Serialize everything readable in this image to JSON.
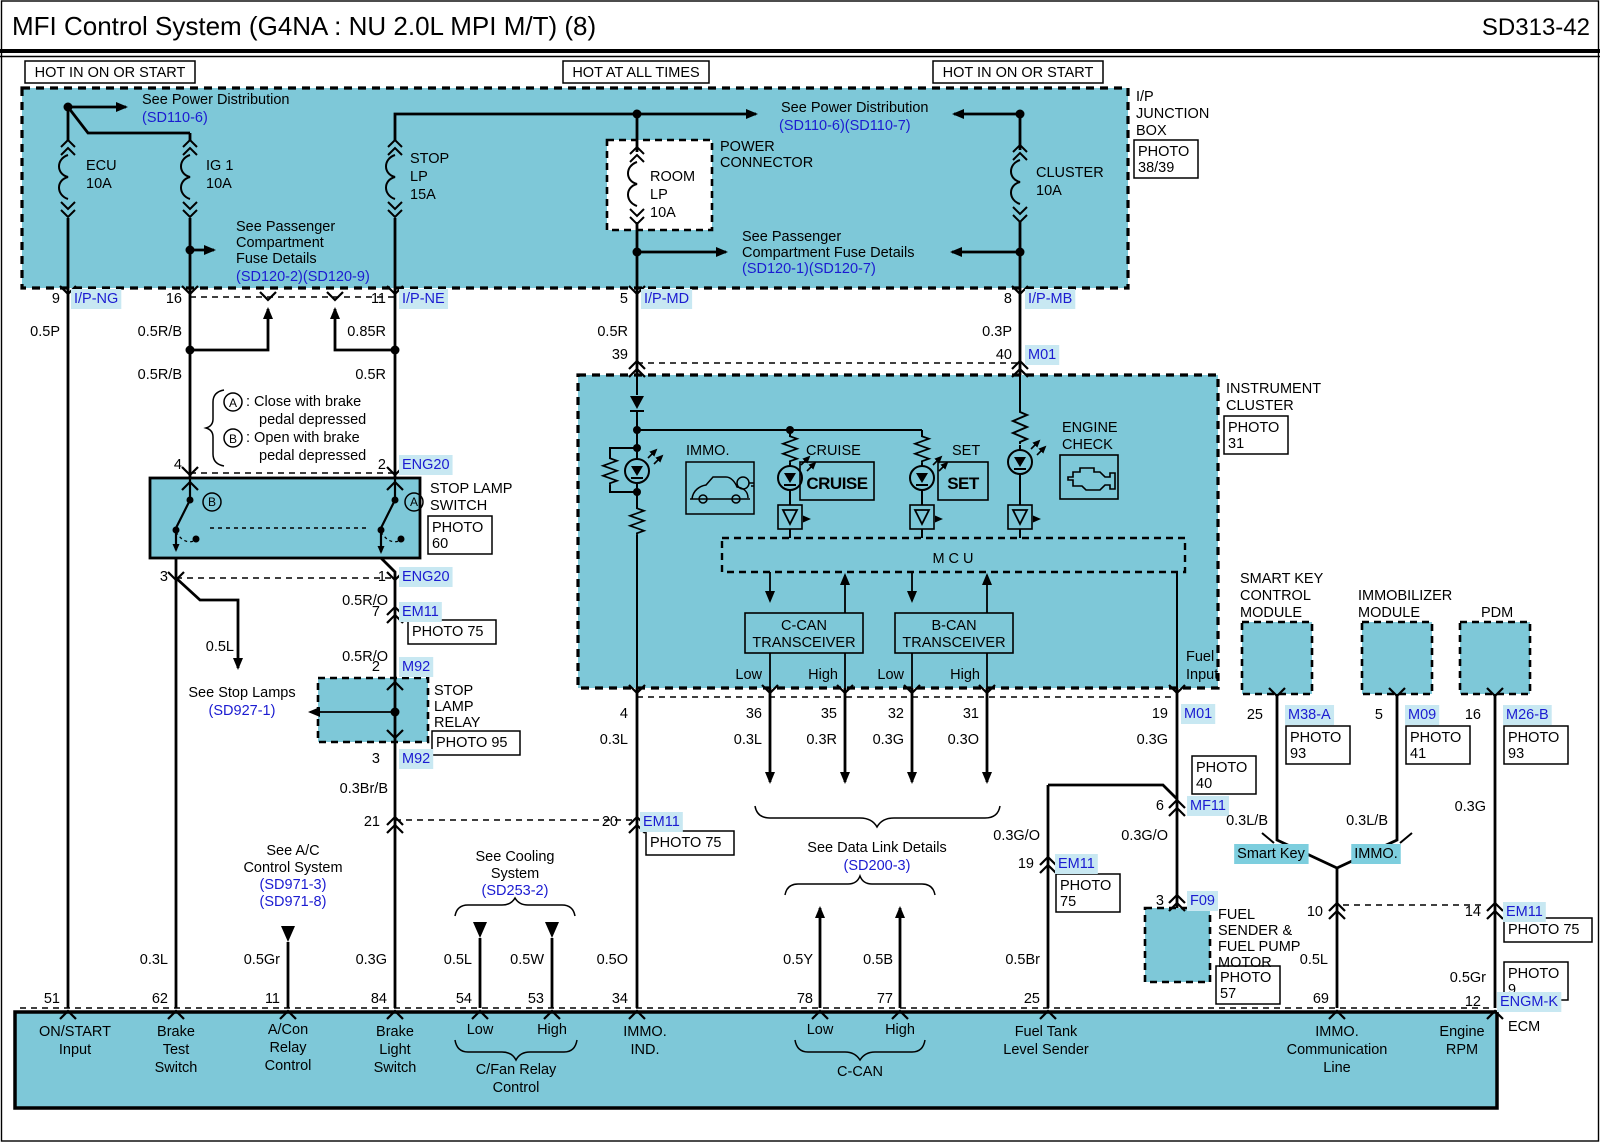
{
  "title": "MFI Control System (G4NA : NU 2.0L MPI M/T) (8)",
  "code": "SD313-42",
  "colors": {
    "fill": "#7ec8d8",
    "blue": "#1b1bd1",
    "hl": "#c8e8f2",
    "tag": "#7dcede",
    "line": "#000000"
  },
  "headers": [
    {
      "t": "HOT IN ON OR START",
      "x": 25,
      "y": 61,
      "w": 170,
      "h": 22
    },
    {
      "t": "HOT AT ALL TIMES",
      "x": 563,
      "y": 61,
      "w": 146,
      "h": 22
    },
    {
      "t": "HOT IN ON OR START",
      "x": 933,
      "y": 61,
      "w": 170,
      "h": 22
    }
  ],
  "photo_boxes": [
    {
      "lines": [
        "PHOTO",
        "38/39"
      ],
      "x": 1134,
      "y": 140,
      "w": 64,
      "h": 38
    },
    {
      "lines": [
        "PHOTO",
        "31"
      ],
      "x": 1224,
      "y": 416,
      "w": 64,
      "h": 38
    },
    {
      "lines": [
        "PHOTO",
        "60"
      ],
      "x": 428,
      "y": 516,
      "w": 64,
      "h": 38
    },
    {
      "lines": [
        "PHOTO 75"
      ],
      "x": 408,
      "y": 620,
      "w": 88,
      "h": 24
    },
    {
      "lines": [
        "PHOTO 95"
      ],
      "x": 432,
      "y": 731,
      "w": 88,
      "h": 24
    },
    {
      "lines": [
        "PHOTO 75"
      ],
      "x": 646,
      "y": 831,
      "w": 88,
      "h": 24
    },
    {
      "lines": [
        "PHOTO",
        "40"
      ],
      "x": 1192,
      "y": 756,
      "w": 64,
      "h": 38
    },
    {
      "lines": [
        "PHOTO",
        "75"
      ],
      "x": 1056,
      "y": 874,
      "w": 64,
      "h": 38
    },
    {
      "lines": [
        "PHOTO",
        "57"
      ],
      "x": 1216,
      "y": 966,
      "w": 64,
      "h": 38
    },
    {
      "lines": [
        "PHOTO",
        "93"
      ],
      "x": 1286,
      "y": 726,
      "w": 64,
      "h": 38
    },
    {
      "lines": [
        "PHOTO",
        "41"
      ],
      "x": 1406,
      "y": 726,
      "w": 64,
      "h": 38
    },
    {
      "lines": [
        "PHOTO",
        "93"
      ],
      "x": 1504,
      "y": 726,
      "w": 64,
      "h": 38
    },
    {
      "lines": [
        "PHOTO 75"
      ],
      "x": 1504,
      "y": 918,
      "w": 88,
      "h": 24
    },
    {
      "lines": [
        "PHOTO",
        "9"
      ],
      "x": 1504,
      "y": 962,
      "w": 64,
      "h": 38
    }
  ],
  "labels": [
    {
      "t": "See Power Distribution",
      "x": 142,
      "y": 104
    },
    {
      "t": "(SD110-6)",
      "x": 142,
      "y": 122,
      "c": "b"
    },
    {
      "t": "ECU",
      "x": 86,
      "y": 170
    },
    {
      "t": "10A",
      "x": 86,
      "y": 188
    },
    {
      "t": "IG 1",
      "x": 206,
      "y": 170
    },
    {
      "t": "10A",
      "x": 206,
      "y": 188
    },
    {
      "t": "See Passenger",
      "x": 236,
      "y": 231
    },
    {
      "t": "Compartment",
      "x": 236,
      "y": 247
    },
    {
      "t": "Fuse Details",
      "x": 236,
      "y": 263
    },
    {
      "t": "(SD120-2)(SD120-9)",
      "x": 236,
      "y": 281,
      "c": "b"
    },
    {
      "t": "STOP",
      "x": 410,
      "y": 163
    },
    {
      "t": "LP",
      "x": 410,
      "y": 181
    },
    {
      "t": "15A",
      "x": 410,
      "y": 199
    },
    {
      "t": "ROOM",
      "x": 650,
      "y": 181
    },
    {
      "t": "LP",
      "x": 650,
      "y": 199
    },
    {
      "t": "10A",
      "x": 650,
      "y": 217
    },
    {
      "t": "POWER",
      "x": 720,
      "y": 151
    },
    {
      "t": "CONNECTOR",
      "x": 720,
      "y": 167
    },
    {
      "t": "See Power Distribution",
      "x": 781,
      "y": 112
    },
    {
      "t": "(SD110-6)(SD110-7)",
      "x": 779,
      "y": 130,
      "c": "b"
    },
    {
      "t": "See Passenger",
      "x": 742,
      "y": 241
    },
    {
      "t": "Compartment Fuse Details",
      "x": 742,
      "y": 257
    },
    {
      "t": "(SD120-1)(SD120-7)",
      "x": 742,
      "y": 273,
      "c": "b"
    },
    {
      "t": "CLUSTER",
      "x": 1036,
      "y": 177
    },
    {
      "t": "10A",
      "x": 1036,
      "y": 195
    },
    {
      "t": "I/P",
      "x": 1136,
      "y": 101
    },
    {
      "t": "JUNCTION",
      "x": 1136,
      "y": 118
    },
    {
      "t": "BOX",
      "x": 1136,
      "y": 135
    },
    {
      "t": "9",
      "x": 60,
      "y": 303,
      "a": "e"
    },
    {
      "t": "I/P-NG",
      "x": 74,
      "y": 303,
      "c": "b",
      "bg": 1
    },
    {
      "t": "16",
      "x": 182,
      "y": 303,
      "a": "e"
    },
    {
      "t": "11",
      "x": 386,
      "y": 303,
      "a": "e"
    },
    {
      "t": "I/P-NE",
      "x": 402,
      "y": 303,
      "c": "b",
      "bg": 1
    },
    {
      "t": "5",
      "x": 628,
      "y": 303,
      "a": "e"
    },
    {
      "t": "I/P-MD",
      "x": 644,
      "y": 303,
      "c": "b",
      "bg": 1
    },
    {
      "t": "8",
      "x": 1012,
      "y": 303,
      "a": "e"
    },
    {
      "t": "I/P-MB",
      "x": 1028,
      "y": 303,
      "c": "b",
      "bg": 1
    },
    {
      "t": "0.5P",
      "x": 60,
      "y": 336,
      "a": "e"
    },
    {
      "t": "0.5R/B",
      "x": 182,
      "y": 336,
      "a": "e"
    },
    {
      "t": "0.85R",
      "x": 386,
      "y": 336,
      "a": "e"
    },
    {
      "t": "0.5R",
      "x": 628,
      "y": 336,
      "a": "e"
    },
    {
      "t": "0.3P",
      "x": 1012,
      "y": 336,
      "a": "e"
    },
    {
      "t": "39",
      "x": 628,
      "y": 359,
      "a": "e"
    },
    {
      "t": "40",
      "x": 1012,
      "y": 359,
      "a": "e"
    },
    {
      "t": "M01",
      "x": 1028,
      "y": 359,
      "c": "b",
      "bg": 1
    },
    {
      "t": "0.5R/B",
      "x": 182,
      "y": 379,
      "a": "e"
    },
    {
      "t": "0.5R",
      "x": 386,
      "y": 379,
      "a": "e"
    },
    {
      "t": "A",
      "x": 233,
      "y": 407,
      "a": "m",
      "s": 12
    },
    {
      "t": ": Close with brake",
      "x": 246,
      "y": 406
    },
    {
      "t": "pedal depressed",
      "x": 259,
      "y": 424
    },
    {
      "t": "B",
      "x": 233,
      "y": 443,
      "a": "m",
      "s": 12
    },
    {
      "t": ": Open with brake",
      "x": 246,
      "y": 442
    },
    {
      "t": "pedal depressed",
      "x": 259,
      "y": 460
    },
    {
      "t": "4",
      "x": 182,
      "y": 469,
      "a": "e"
    },
    {
      "t": "2",
      "x": 386,
      "y": 469,
      "a": "e"
    },
    {
      "t": "ENG20",
      "x": 402,
      "y": 469,
      "c": "b",
      "bg": 1
    },
    {
      "t": "B",
      "x": 212,
      "y": 506,
      "a": "m",
      "s": 12
    },
    {
      "t": "A",
      "x": 414,
      "y": 506,
      "a": "m",
      "s": 12
    },
    {
      "t": "STOP LAMP",
      "x": 430,
      "y": 493
    },
    {
      "t": "SWITCH",
      "x": 430,
      "y": 510
    },
    {
      "t": "3",
      "x": 168,
      "y": 581,
      "a": "e"
    },
    {
      "t": "1",
      "x": 386,
      "y": 581,
      "a": "e"
    },
    {
      "t": "ENG20",
      "x": 402,
      "y": 581,
      "c": "b",
      "bg": 1
    },
    {
      "t": "0.5R/O",
      "x": 388,
      "y": 605,
      "a": "e"
    },
    {
      "t": "7",
      "x": 380,
      "y": 616,
      "a": "e"
    },
    {
      "t": "EM11",
      "x": 402,
      "y": 616,
      "c": "b",
      "bg": 1
    },
    {
      "t": "0.5R/O",
      "x": 388,
      "y": 661,
      "a": "e"
    },
    {
      "t": "2",
      "x": 380,
      "y": 671,
      "a": "e"
    },
    {
      "t": "M92",
      "x": 402,
      "y": 671,
      "c": "b",
      "bg": 1
    },
    {
      "t": "0.5L",
      "x": 234,
      "y": 651,
      "a": "e"
    },
    {
      "t": "See Stop Lamps",
      "x": 242,
      "y": 697,
      "a": "m"
    },
    {
      "t": "(SD927-1)",
      "x": 242,
      "y": 715,
      "a": "m",
      "c": "b"
    },
    {
      "t": "STOP",
      "x": 434,
      "y": 695
    },
    {
      "t": "LAMP",
      "x": 434,
      "y": 711
    },
    {
      "t": "RELAY",
      "x": 434,
      "y": 727
    },
    {
      "t": "3",
      "x": 380,
      "y": 763,
      "a": "e"
    },
    {
      "t": "M92",
      "x": 402,
      "y": 763,
      "c": "b",
      "bg": 1
    },
    {
      "t": "0.3Br/B",
      "x": 388,
      "y": 793,
      "a": "e"
    },
    {
      "t": "21",
      "x": 380,
      "y": 826,
      "a": "e"
    },
    {
      "t": "20",
      "x": 618,
      "y": 826,
      "a": "e"
    },
    {
      "t": "EM11",
      "x": 643,
      "y": 826,
      "c": "b",
      "bg": 1
    },
    {
      "t": "See A/C",
      "x": 293,
      "y": 855,
      "a": "m"
    },
    {
      "t": "Control System",
      "x": 293,
      "y": 872,
      "a": "m"
    },
    {
      "t": "(SD971-3)",
      "x": 293,
      "y": 889,
      "a": "m",
      "c": "b"
    },
    {
      "t": "(SD971-8)",
      "x": 293,
      "y": 906,
      "a": "m",
      "c": "b"
    },
    {
      "t": "See Cooling",
      "x": 515,
      "y": 861,
      "a": "m"
    },
    {
      "t": "System",
      "x": 515,
      "y": 878,
      "a": "m"
    },
    {
      "t": "(SD253-2)",
      "x": 515,
      "y": 895,
      "a": "m",
      "c": "b"
    },
    {
      "t": "INSTRUMENT",
      "x": 1226,
      "y": 393
    },
    {
      "t": "CLUSTER",
      "x": 1226,
      "y": 410
    },
    {
      "t": "IMMO.",
      "x": 686,
      "y": 455
    },
    {
      "t": "CRUISE",
      "x": 806,
      "y": 455
    },
    {
      "t": "SET",
      "x": 952,
      "y": 455
    },
    {
      "t": "ENGINE",
      "x": 1062,
      "y": 432
    },
    {
      "t": "CHECK",
      "x": 1062,
      "y": 449
    },
    {
      "t": "CRUISE",
      "x": 837,
      "y": 489,
      "a": "m",
      "big": 1
    },
    {
      "t": "SET",
      "x": 963,
      "y": 489,
      "a": "m",
      "big": 1
    },
    {
      "t": "M C U",
      "x": 953,
      "y": 563,
      "a": "m"
    },
    {
      "t": "C-CAN",
      "x": 804,
      "y": 630,
      "a": "m"
    },
    {
      "t": "TRANSCEIVER",
      "x": 804,
      "y": 647,
      "a": "m"
    },
    {
      "t": "B-CAN",
      "x": 954,
      "y": 630,
      "a": "m"
    },
    {
      "t": "TRANSCEIVER",
      "x": 954,
      "y": 647,
      "a": "m"
    },
    {
      "t": "Low",
      "x": 762,
      "y": 679,
      "a": "e"
    },
    {
      "t": "High",
      "x": 838,
      "y": 679,
      "a": "e"
    },
    {
      "t": "Low",
      "x": 904,
      "y": 679,
      "a": "e"
    },
    {
      "t": "High",
      "x": 980,
      "y": 679,
      "a": "e"
    },
    {
      "t": "Fuel",
      "x": 1186,
      "y": 661
    },
    {
      "t": "Input",
      "x": 1186,
      "y": 679
    },
    {
      "t": "4",
      "x": 628,
      "y": 718,
      "a": "e"
    },
    {
      "t": "36",
      "x": 762,
      "y": 718,
      "a": "e"
    },
    {
      "t": "35",
      "x": 837,
      "y": 718,
      "a": "e"
    },
    {
      "t": "32",
      "x": 904,
      "y": 718,
      "a": "e"
    },
    {
      "t": "31",
      "x": 979,
      "y": 718,
      "a": "e"
    },
    {
      "t": "19",
      "x": 1168,
      "y": 718,
      "a": "e"
    },
    {
      "t": "M01",
      "x": 1184,
      "y": 718,
      "c": "b",
      "bg": 1
    },
    {
      "t": "0.3L",
      "x": 628,
      "y": 744,
      "a": "e"
    },
    {
      "t": "0.3L",
      "x": 762,
      "y": 744,
      "a": "e"
    },
    {
      "t": "0.3R",
      "x": 837,
      "y": 744,
      "a": "e"
    },
    {
      "t": "0.3G",
      "x": 904,
      "y": 744,
      "a": "e"
    },
    {
      "t": "0.3O",
      "x": 979,
      "y": 744,
      "a": "e"
    },
    {
      "t": "0.3G",
      "x": 1168,
      "y": 744,
      "a": "e"
    },
    {
      "t": "6",
      "x": 1164,
      "y": 810,
      "a": "e"
    },
    {
      "t": "MF11",
      "x": 1190,
      "y": 810,
      "c": "b",
      "bg": 1
    },
    {
      "t": "0.3G/O",
      "x": 1040,
      "y": 840,
      "a": "e"
    },
    {
      "t": "0.3G/O",
      "x": 1168,
      "y": 840,
      "a": "e"
    },
    {
      "t": "See Data Link Details",
      "x": 877,
      "y": 852,
      "a": "m"
    },
    {
      "t": "(SD200-3)",
      "x": 877,
      "y": 870,
      "a": "m",
      "c": "b"
    },
    {
      "t": "19",
      "x": 1034,
      "y": 868,
      "a": "e"
    },
    {
      "t": "EM11",
      "x": 1058,
      "y": 868,
      "c": "b",
      "bg": 1
    },
    {
      "t": "3",
      "x": 1164,
      "y": 905,
      "a": "e"
    },
    {
      "t": "F09",
      "x": 1190,
      "y": 905,
      "c": "b",
      "bg": 1
    },
    {
      "t": "FUEL",
      "x": 1218,
      "y": 919
    },
    {
      "t": "SENDER &",
      "x": 1218,
      "y": 935
    },
    {
      "t": "FUEL PUMP",
      "x": 1218,
      "y": 951
    },
    {
      "t": "MOTOR",
      "x": 1218,
      "y": 967
    },
    {
      "t": "SMART KEY",
      "x": 1240,
      "y": 583
    },
    {
      "t": "CONTROL",
      "x": 1240,
      "y": 600
    },
    {
      "t": "MODULE",
      "x": 1240,
      "y": 617
    },
    {
      "t": "IMMOBILIZER",
      "x": 1358,
      "y": 600
    },
    {
      "t": "MODULE",
      "x": 1358,
      "y": 617
    },
    {
      "t": "PDM",
      "x": 1481,
      "y": 617
    },
    {
      "t": "25",
      "x": 1263,
      "y": 719,
      "a": "e"
    },
    {
      "t": "M38-A",
      "x": 1288,
      "y": 719,
      "c": "b",
      "bg": 1
    },
    {
      "t": "5",
      "x": 1383,
      "y": 719,
      "a": "e"
    },
    {
      "t": "M09",
      "x": 1408,
      "y": 719,
      "c": "b",
      "bg": 1
    },
    {
      "t": "16",
      "x": 1481,
      "y": 719,
      "a": "e"
    },
    {
      "t": "M26-B",
      "x": 1506,
      "y": 719,
      "c": "b",
      "bg": 1
    },
    {
      "t": "0.3L/B",
      "x": 1268,
      "y": 825,
      "a": "e"
    },
    {
      "t": "0.3L/B",
      "x": 1388,
      "y": 825,
      "a": "e"
    },
    {
      "t": "0.3G",
      "x": 1486,
      "y": 811,
      "a": "e"
    },
    {
      "t": "Smart Key",
      "x": 1271,
      "y": 858,
      "a": "m",
      "tag": 1
    },
    {
      "t": "IMMO.",
      "x": 1376,
      "y": 858,
      "a": "m",
      "tag": 1
    },
    {
      "t": "10",
      "x": 1323,
      "y": 916,
      "a": "e"
    },
    {
      "t": "14",
      "x": 1481,
      "y": 916,
      "a": "e"
    },
    {
      "t": "EM11",
      "x": 1506,
      "y": 916,
      "c": "b",
      "bg": 1
    },
    {
      "t": "0.5L",
      "x": 1328,
      "y": 964,
      "a": "e"
    },
    {
      "t": "0.5Gr",
      "x": 1486,
      "y": 982,
      "a": "e"
    },
    {
      "t": "12",
      "x": 1481,
      "y": 1006,
      "a": "e"
    },
    {
      "t": "ENGM-K",
      "x": 1500,
      "y": 1006,
      "c": "b",
      "bg": 1
    },
    {
      "t": "ECM",
      "x": 1508,
      "y": 1031
    },
    {
      "t": "51",
      "x": 60,
      "y": 1003,
      "a": "e"
    },
    {
      "t": "62",
      "x": 168,
      "y": 1003,
      "a": "e"
    },
    {
      "t": "11",
      "x": 280,
      "y": 1003,
      "a": "e"
    },
    {
      "t": "84",
      "x": 387,
      "y": 1003,
      "a": "e"
    },
    {
      "t": "54",
      "x": 472,
      "y": 1003,
      "a": "e"
    },
    {
      "t": "53",
      "x": 544,
      "y": 1003,
      "a": "e"
    },
    {
      "t": "34",
      "x": 628,
      "y": 1003,
      "a": "e"
    },
    {
      "t": "78",
      "x": 813,
      "y": 1003,
      "a": "e"
    },
    {
      "t": "77",
      "x": 893,
      "y": 1003,
      "a": "e"
    },
    {
      "t": "25",
      "x": 1040,
      "y": 1003,
      "a": "e"
    },
    {
      "t": "69",
      "x": 1329,
      "y": 1003,
      "a": "e"
    },
    {
      "t": "0.3L",
      "x": 168,
      "y": 964,
      "a": "e"
    },
    {
      "t": "0.5Gr",
      "x": 280,
      "y": 964,
      "a": "e"
    },
    {
      "t": "0.3G",
      "x": 387,
      "y": 964,
      "a": "e"
    },
    {
      "t": "0.5L",
      "x": 472,
      "y": 964,
      "a": "e"
    },
    {
      "t": "0.5W",
      "x": 544,
      "y": 964,
      "a": "e"
    },
    {
      "t": "0.5O",
      "x": 628,
      "y": 964,
      "a": "e"
    },
    {
      "t": "0.5Y",
      "x": 813,
      "y": 964,
      "a": "e"
    },
    {
      "t": "0.5B",
      "x": 893,
      "y": 964,
      "a": "e"
    },
    {
      "t": "0.5Br",
      "x": 1040,
      "y": 964,
      "a": "e"
    },
    {
      "t": "ON/START",
      "x": 75,
      "y": 1036,
      "a": "m"
    },
    {
      "t": "Input",
      "x": 75,
      "y": 1054,
      "a": "m"
    },
    {
      "t": "Brake",
      "x": 176,
      "y": 1036,
      "a": "m"
    },
    {
      "t": "Test",
      "x": 176,
      "y": 1054,
      "a": "m"
    },
    {
      "t": "Switch",
      "x": 176,
      "y": 1072,
      "a": "m"
    },
    {
      "t": "A/Con",
      "x": 288,
      "y": 1034,
      "a": "m"
    },
    {
      "t": "Relay",
      "x": 288,
      "y": 1052,
      "a": "m"
    },
    {
      "t": "Control",
      "x": 288,
      "y": 1070,
      "a": "m"
    },
    {
      "t": "Brake",
      "x": 395,
      "y": 1036,
      "a": "m"
    },
    {
      "t": "Light",
      "x": 395,
      "y": 1054,
      "a": "m"
    },
    {
      "t": "Switch",
      "x": 395,
      "y": 1072,
      "a": "m"
    },
    {
      "t": "Low",
      "x": 480,
      "y": 1034,
      "a": "m"
    },
    {
      "t": "High",
      "x": 552,
      "y": 1034,
      "a": "m"
    },
    {
      "t": "C/Fan Relay",
      "x": 516,
      "y": 1074,
      "a": "m"
    },
    {
      "t": "Control",
      "x": 516,
      "y": 1092,
      "a": "m"
    },
    {
      "t": "IMMO.",
      "x": 645,
      "y": 1036,
      "a": "m"
    },
    {
      "t": "IND.",
      "x": 645,
      "y": 1054,
      "a": "m"
    },
    {
      "t": "Low",
      "x": 820,
      "y": 1034,
      "a": "m"
    },
    {
      "t": "High",
      "x": 900,
      "y": 1034,
      "a": "m"
    },
    {
      "t": "C-CAN",
      "x": 860,
      "y": 1076,
      "a": "m"
    },
    {
      "t": "Fuel Tank",
      "x": 1046,
      "y": 1036,
      "a": "m"
    },
    {
      "t": "Level Sender",
      "x": 1046,
      "y": 1054,
      "a": "m"
    },
    {
      "t": "IMMO.",
      "x": 1337,
      "y": 1036,
      "a": "m"
    },
    {
      "t": "Communication",
      "x": 1337,
      "y": 1054,
      "a": "m"
    },
    {
      "t": "Line",
      "x": 1337,
      "y": 1072,
      "a": "m"
    },
    {
      "t": "Engine",
      "x": 1462,
      "y": 1036,
      "a": "m"
    },
    {
      "t": "RPM",
      "x": 1462,
      "y": 1054,
      "a": "m"
    }
  ]
}
